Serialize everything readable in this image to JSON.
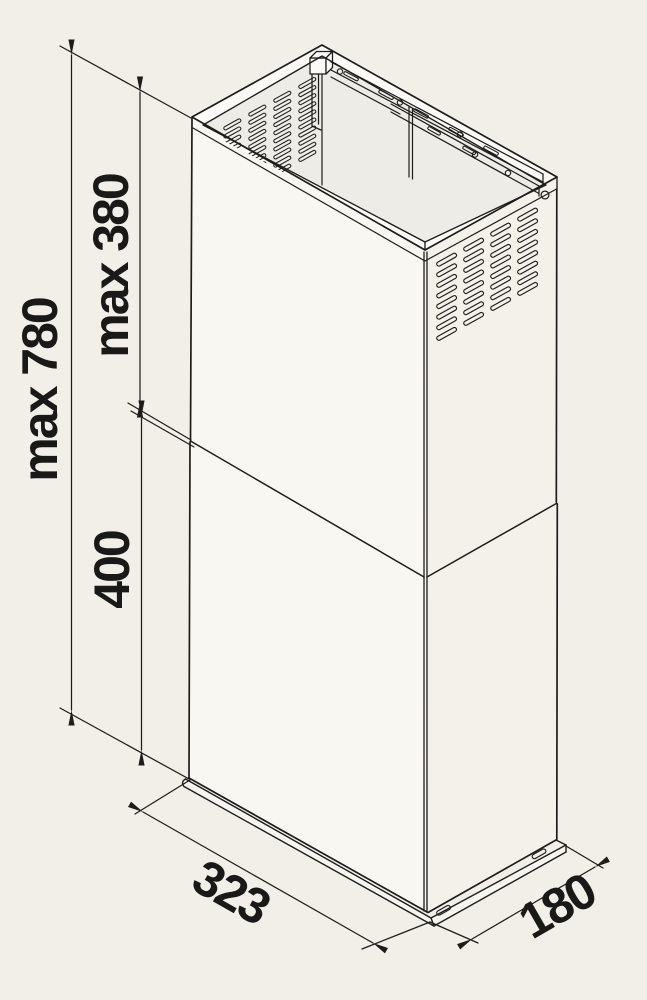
{
  "diagram": {
    "title": "chimney-duct-dimension-drawing",
    "labels": {
      "height_total": "max 780",
      "height_upper": "max 380",
      "height_lower": "400",
      "width": "323",
      "depth": "180"
    },
    "colors": {
      "background": "#f2efe9",
      "line": "#1d1d1b",
      "text": "#191918"
    }
  }
}
